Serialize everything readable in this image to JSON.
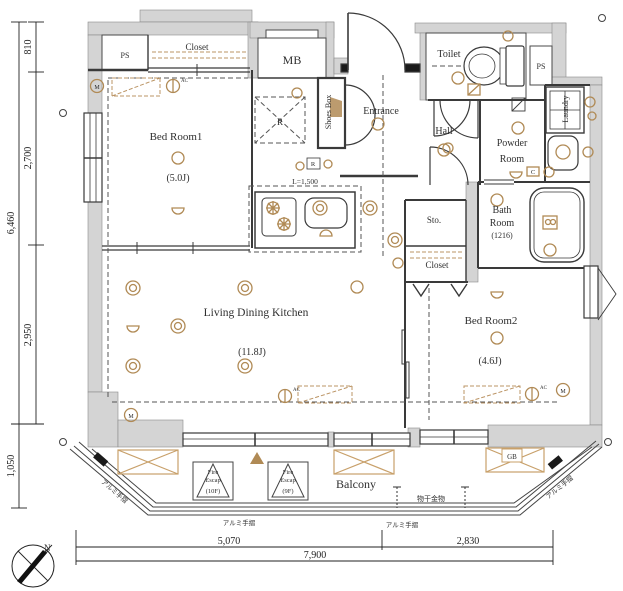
{
  "colors": {
    "wall_fill": "#d4d4d4",
    "line": "#3a3a3a",
    "accent_tan": "#b08a55"
  },
  "rooms": {
    "bed_room1": {
      "name": "Bed Room1",
      "area": "(5.0J)"
    },
    "ldk": {
      "name": "Living Dining Kitchen",
      "area": "(11.8J)"
    },
    "bed_room2": {
      "name": "Bed Room2",
      "area": "(4.6J)"
    },
    "bath": {
      "line1": "Bath",
      "line2": "Room",
      "size": "(1216)"
    },
    "powder": {
      "line1": "Powder",
      "line2": "Room"
    },
    "toilet": {
      "name": "Toilet"
    },
    "hall": {
      "name": "Hall"
    },
    "entrance": {
      "name": "Entrance"
    },
    "shoes_box": {
      "name": "Shoes Box"
    },
    "laundry": {
      "name": "Laundry"
    },
    "closet_top": {
      "name": "Closet"
    },
    "closet_mid": {
      "name": "Closet"
    },
    "storage": {
      "name": "Sto."
    },
    "mb": {
      "name": "MB"
    },
    "ps_left": {
      "name": "PS"
    },
    "ps_right": {
      "name": "PS"
    },
    "balcony": {
      "name": "Balcony"
    }
  },
  "labels": {
    "kitchen_counter": "L=1,500",
    "refrigerator": "R",
    "outlet_r": "R",
    "gas_box": "GB",
    "c_box": "C",
    "north": "N",
    "laundry_pole": "物干金物",
    "handrail": "アルミ手摺",
    "ac": "AC",
    "meter": "M",
    "fire_escape_1": {
      "l1": "Fire",
      "l2": "Escap",
      "l3": "(10F)"
    },
    "fire_escape_2": {
      "l1": "Fire",
      "l2": "Escap",
      "l3": "(9F)"
    }
  },
  "dimensions": {
    "v810": "810",
    "v2700": "2,700",
    "v2950": "2,950",
    "v6460": "6,460",
    "v1050": "1,050",
    "h5070": "5,070",
    "h2830": "2,830",
    "h7900": "7,900"
  }
}
